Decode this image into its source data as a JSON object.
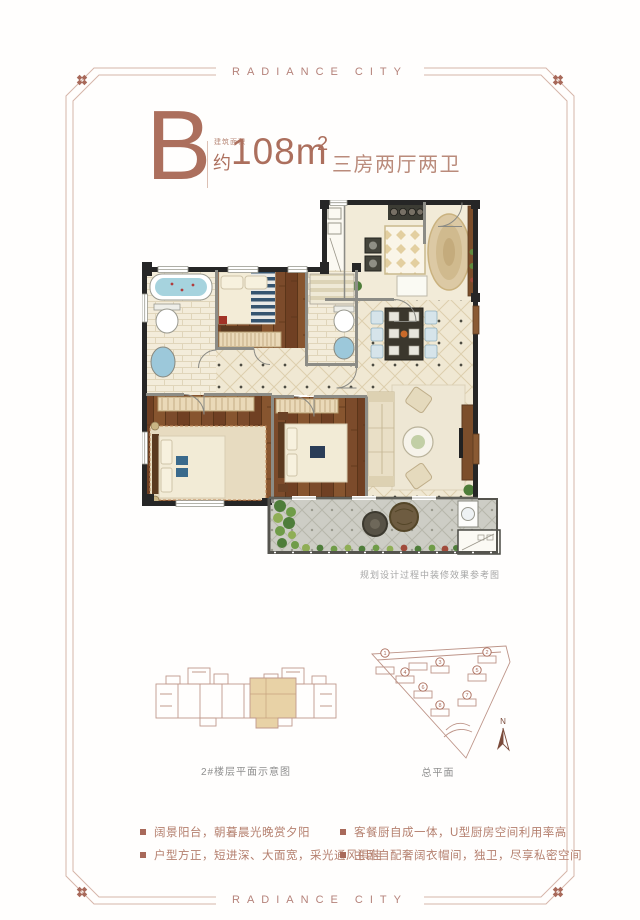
{
  "brand": {
    "top": "RADIANCE CITY",
    "bottom": "RADIANCE CITY"
  },
  "title": {
    "unit_type": "B",
    "area_note": "建筑面积",
    "area_approx": "约",
    "area_number": "108",
    "area_unit": "m",
    "area_exponent": "2",
    "rooms": "三房两厅两卫"
  },
  "floor_plan": {
    "disclaimer": "规划设计过程中装修效果参考图"
  },
  "diagrams": {
    "key_plan_caption": "2#楼层平面示意图",
    "site_plan_caption": "总平面",
    "north_label": "N",
    "site_building_numbers": [
      "1",
      "2",
      "3",
      "4",
      "5",
      "6",
      "7",
      "8"
    ]
  },
  "features": {
    "items": [
      "阔景阳台，朝暮晨光晚赏夕阳",
      "户型方正，短进深、大面宽，采光通风俱佳",
      "客餐厨自成一体，U型厨房空间利用率高",
      "主卧自配奢阔衣帽间，独卫，尽享私密空间"
    ]
  },
  "colors": {
    "accent": "#ac6f5d",
    "frame": "#d6b5a9",
    "highlight": "#e8d2a6"
  }
}
